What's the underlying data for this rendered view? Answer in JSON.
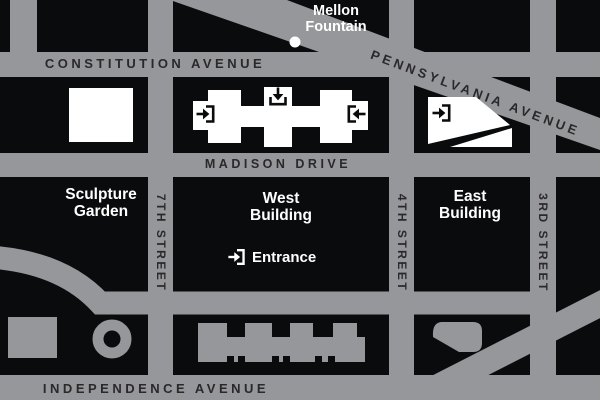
{
  "map": {
    "streets": {
      "constitution_avenue": "CONSTITUTION AVENUE",
      "pennsylvania_avenue": "PENNSYLVANIA AVENUE",
      "madison_drive": "MADISON DRIVE",
      "independence_avenue": "INDEPENDENCE AVENUE",
      "seventh_street": "7TH STREET",
      "fourth_street": "4TH STREET",
      "third_street": "3RD STREET"
    },
    "landmarks": {
      "mellon_fountain": {
        "line1": "Mellon",
        "line2": "Fountain"
      },
      "sculpture_garden": {
        "line1": "Sculpture",
        "line2": "Garden"
      },
      "west_building": {
        "line1": "West",
        "line2": "Building"
      },
      "east_building": {
        "line1": "East",
        "line2": "Building"
      },
      "entrance": {
        "label": "Entrance"
      }
    },
    "icons": [
      "entrance-arrow-right-icon",
      "entrance-arrow-down-icon",
      "entrance-arrow-left-icon",
      "fountain-dot-icon"
    ],
    "colors": {
      "street_gray": "#95979a",
      "map_black": "#0a0b0c",
      "label_dark": "#2b282a",
      "label_white": "#ffffff"
    }
  }
}
